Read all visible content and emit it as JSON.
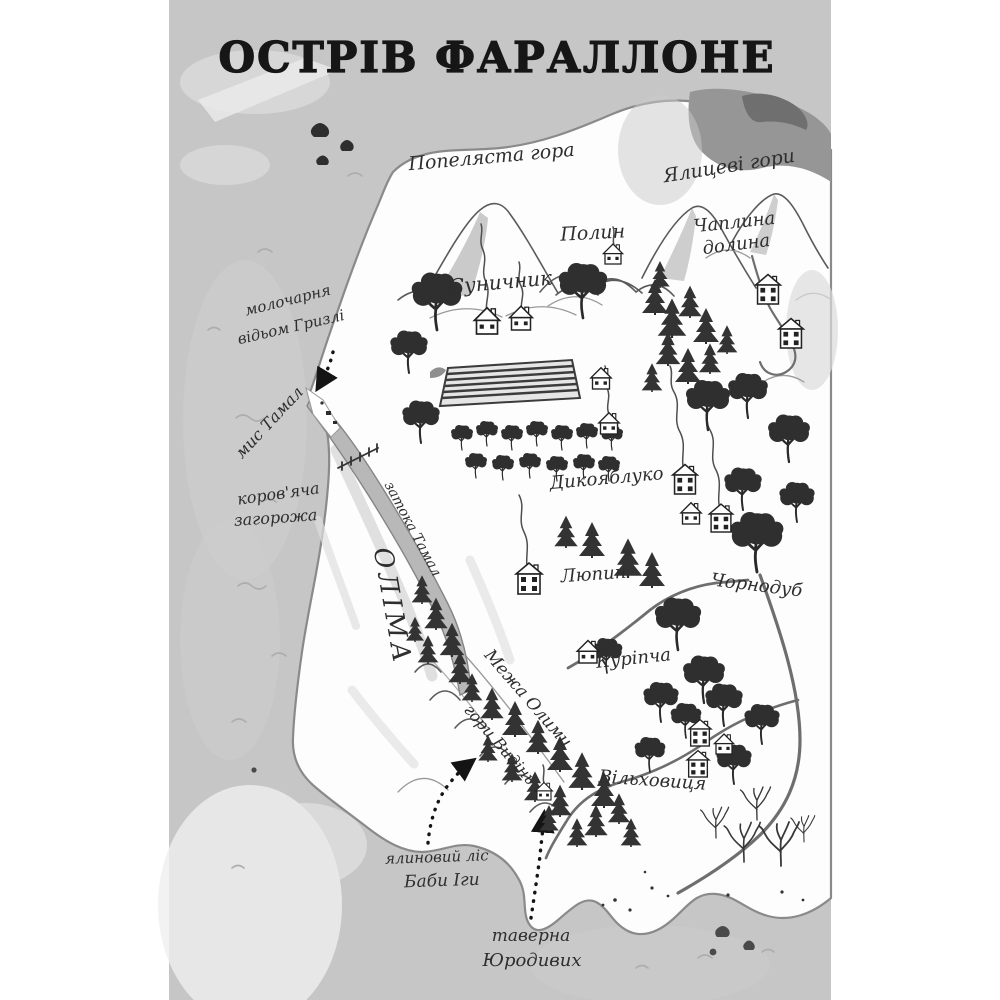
{
  "page": {
    "title": "ОСТРІВ ФАРАЛЛОНЕ"
  },
  "colors": {
    "sea": "#c6c6c6",
    "land": "#fdfdfd",
    "coast": "#8a8a8a",
    "bay": "#b8b8b8",
    "ink": "#2a2a2a",
    "tree": "#2f2f2f",
    "road": "#6e6e6e",
    "label": "#2e2e2e",
    "title": "#161616"
  },
  "labels": {
    "ash_mountain": "Попеляста гора",
    "fir_mountains": "Ялицеві гори",
    "polyn": "Полин",
    "chaplyna_line1": "Чаплина",
    "chaplyna_line2": "долина",
    "sunychnyk": "Суничник",
    "dairy_line1": "молочарня",
    "dairy_line2": "відьом Гризлі",
    "cape_tamal": "мис Тамал",
    "cow_pen_line1": "коров'яча",
    "cow_pen_line2": "загорожа",
    "tamal_bay": "затока Тамал",
    "olima": "ОЛІМА",
    "dykoyabluko": "Дикояблуко",
    "lupyn": "Люпин",
    "chornodub": "Чорнодуб",
    "kuripcha": "Куріпча",
    "olima_border": "Межа Олими",
    "vision_mountains": "гори Видінь",
    "vilkhovytsia": "Вільховиця",
    "spruce_forest_line1": "ялиновий ліс",
    "spruce_forest_line2": "Баби Іги",
    "tavern_line1": "таверна",
    "tavern_line2": "Юродивих"
  }
}
